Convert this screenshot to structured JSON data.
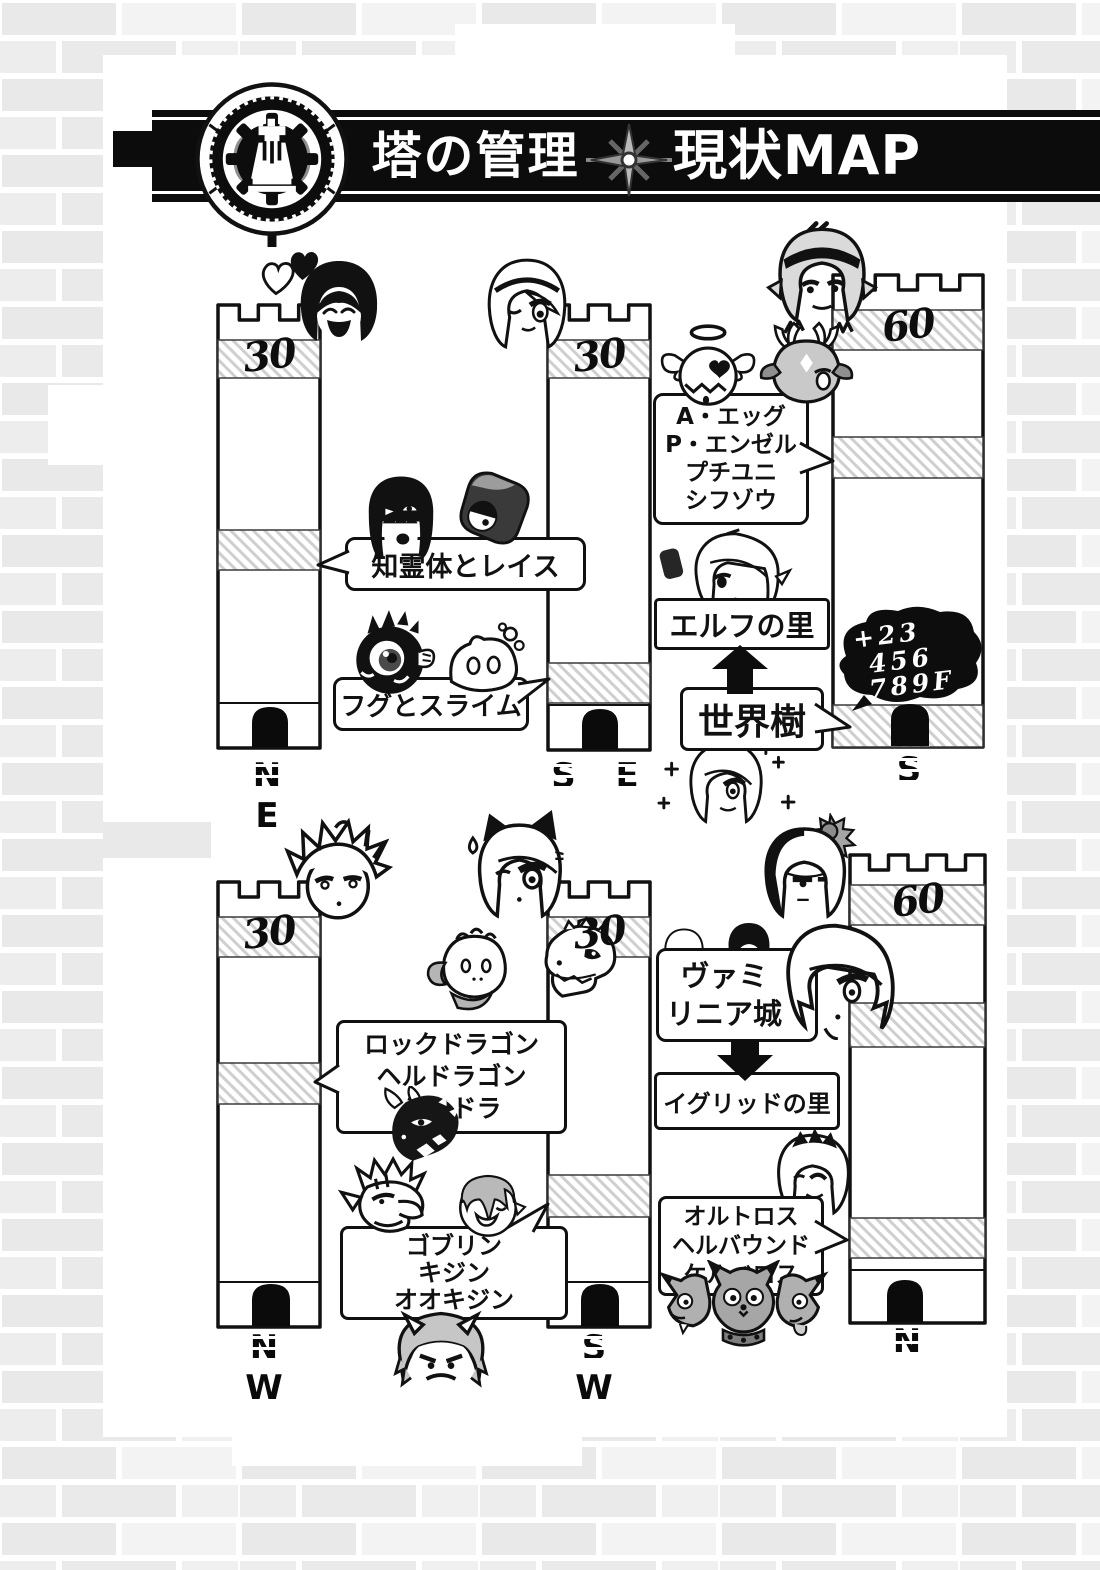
{
  "page_title": "塔の管理 現状MAP",
  "banner": {
    "title_left": "塔の管理",
    "title_right": "現状MAP",
    "emblem_icon": "tower-gear-emblem",
    "divider_icon": "compass-star"
  },
  "towers": [
    {
      "id": "ne",
      "floor": "30",
      "direction": "N E"
    },
    {
      "id": "se",
      "floor": "30",
      "direction": "S E"
    },
    {
      "id": "s",
      "floor": "60",
      "direction": "S",
      "floor_note_lines": [
        "+23",
        "456",
        "789F"
      ]
    },
    {
      "id": "nw",
      "floor": "30",
      "direction": "N W"
    },
    {
      "id": "sw",
      "floor": "30",
      "direction": "S W"
    },
    {
      "id": "n",
      "floor": "60",
      "direction": "N"
    }
  ],
  "callouts": {
    "chireitai": {
      "lines": [
        "知霊体とレイス"
      ]
    },
    "fugu": {
      "lines": [
        "フグとスライム"
      ]
    },
    "egg": {
      "lines": [
        "A・エッグ",
        "P・エンゼル",
        "プチユニ",
        "シフゾウ"
      ]
    },
    "rock": {
      "lines": [
        "ロックドラゴン",
        "ヘルドラゴン",
        "ミニドラ"
      ]
    },
    "goblin": {
      "lines": [
        "ゴブリン",
        "キジン",
        "オオキジン"
      ]
    },
    "ortho": {
      "lines": [
        "オルトロス",
        "ヘルバウンド",
        "ケルベロス"
      ]
    }
  },
  "locations": {
    "elf_village": "エルフの里",
    "world_tree": "世界樹",
    "vamirinia_lines": [
      "ヴァミ",
      "リニア城"
    ],
    "igrid_village": "イグリッドの里"
  },
  "colors": {
    "ink": "#111111",
    "brick": "#e9e9e9",
    "hatch": "#cfcfcf",
    "banner": "#0c0c0c"
  },
  "characters": [
    {
      "name": "love-hearts",
      "kind": "hearts"
    },
    {
      "name": "laughing-dark-haired-girl",
      "kind": "darklaugh"
    },
    {
      "name": "winking-white-haired-girl",
      "kind": "lightwink"
    },
    {
      "name": "chireitai-spirit-girl",
      "kind": "blackbob"
    },
    {
      "name": "wraith",
      "kind": "wraith"
    },
    {
      "name": "pufferfish",
      "kind": "puffer"
    },
    {
      "name": "slime",
      "kind": "slime"
    },
    {
      "name": "angel-egg",
      "kind": "egg"
    },
    {
      "name": "shifuzou-deer",
      "kind": "deer"
    },
    {
      "name": "elf-with-headband",
      "kind": "elfband"
    },
    {
      "name": "elf-village-girl",
      "kind": "elf"
    },
    {
      "name": "world-tree-spirit",
      "kind": "sparkle"
    },
    {
      "name": "spiky-haired-boy",
      "kind": "spiky"
    },
    {
      "name": "cat-eared-girl",
      "kind": "cat"
    },
    {
      "name": "rock-dragon",
      "kind": "rockdragon"
    },
    {
      "name": "hell-dragon",
      "kind": "skulldragon"
    },
    {
      "name": "mini-dragon",
      "kind": "blackdragon"
    },
    {
      "name": "goblin",
      "kind": "goblin"
    },
    {
      "name": "kijin",
      "kind": "kijin"
    },
    {
      "name": "ookijin-oni",
      "kind": "oni"
    },
    {
      "name": "villager-light",
      "kind": "minilight"
    },
    {
      "name": "villager-dark",
      "kind": "minidark"
    },
    {
      "name": "vampire-girl",
      "kind": "vamp"
    },
    {
      "name": "flower-haired-girl",
      "kind": "flowerbob"
    },
    {
      "name": "tiara-girl",
      "kind": "tiara"
    },
    {
      "name": "cerberus",
      "kind": "cerberus"
    }
  ]
}
